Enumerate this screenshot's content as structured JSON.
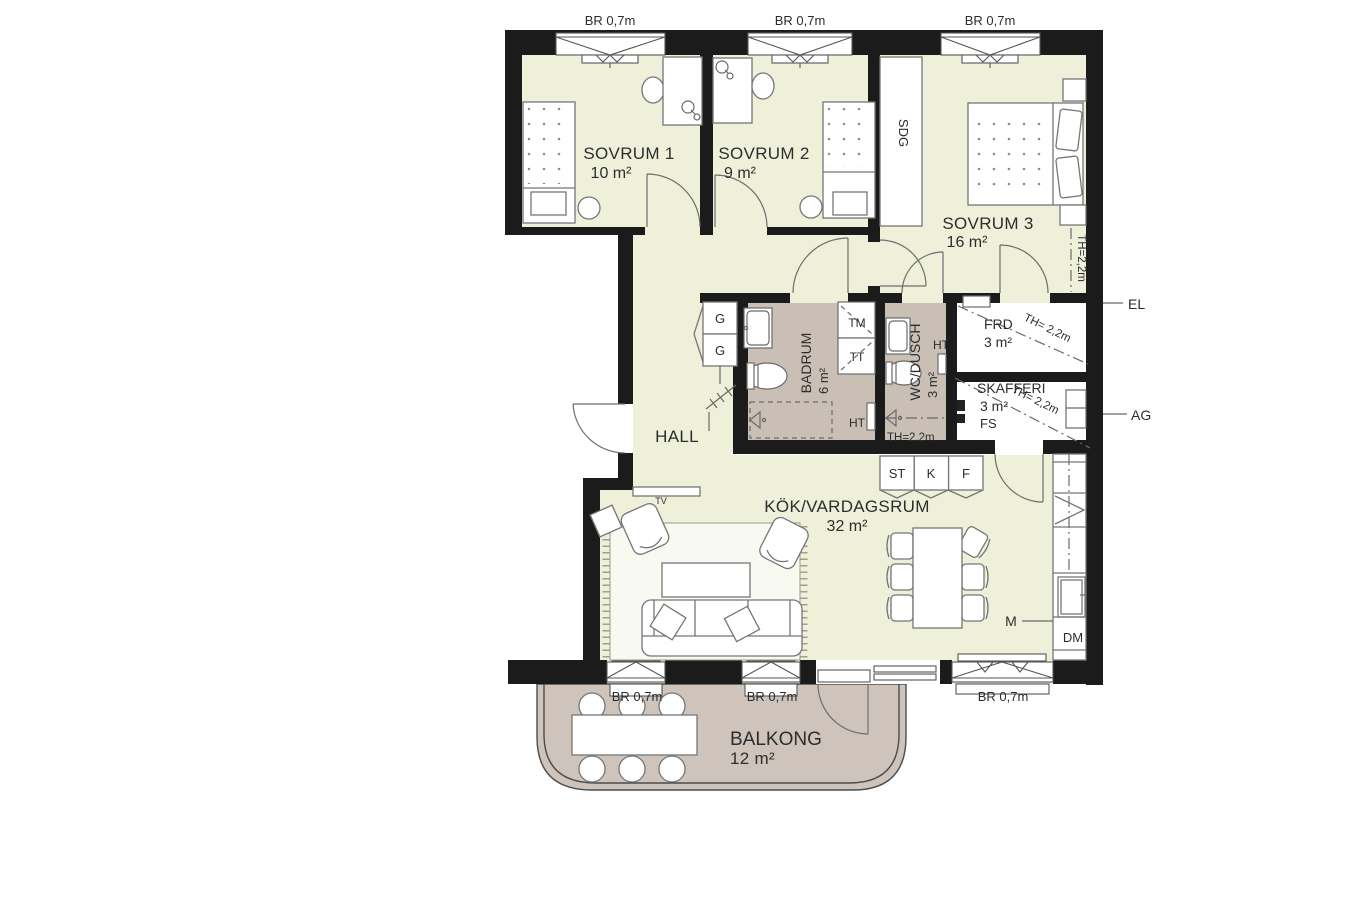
{
  "title": "Apartment floor plan (3 rooms + kitchen)",
  "rooms": {
    "sovrum1": {
      "name": "SOVRUM 1",
      "area": "10 m²"
    },
    "sovrum2": {
      "name": "SOVRUM 2",
      "area": "9 m²"
    },
    "sovrum3": {
      "name": "SOVRUM 3",
      "area": "16 m²"
    },
    "badrum": {
      "name": "BADRUM",
      "area": "6 m²"
    },
    "wc_dusch": {
      "name": "WC/DUSCH",
      "area": "3 m²"
    },
    "frd": {
      "name": "FRD",
      "area": "3 m²"
    },
    "skafferi": {
      "name": "SKAFFERI",
      "area": "3 m²"
    },
    "hall": {
      "name": "HALL"
    },
    "kok_vardagsrum": {
      "name": "KÖK/VARDAGSRUM",
      "area": "32 m²"
    },
    "balkong": {
      "name": "BALKONG",
      "area": "12 m²"
    }
  },
  "windows": {
    "label": "BR 0,7m"
  },
  "annotations": {
    "el": "EL",
    "ag": "AG",
    "sdg": "SDG",
    "tv": "TV",
    "m": "M",
    "dm": "DM",
    "fs": "FS",
    "tm": "TM",
    "tt": "TT",
    "ht": "HT",
    "g": "G",
    "st": "ST",
    "k": "K",
    "f": "F",
    "th_220": "TH=2,2m",
    "th_220_spaced": "TH= 2,2m"
  },
  "colors": {
    "wall": "#1b1b1b",
    "floor": "#eef0da",
    "wet_room": "#c9bfb5",
    "balcony": "#cec4bb"
  }
}
